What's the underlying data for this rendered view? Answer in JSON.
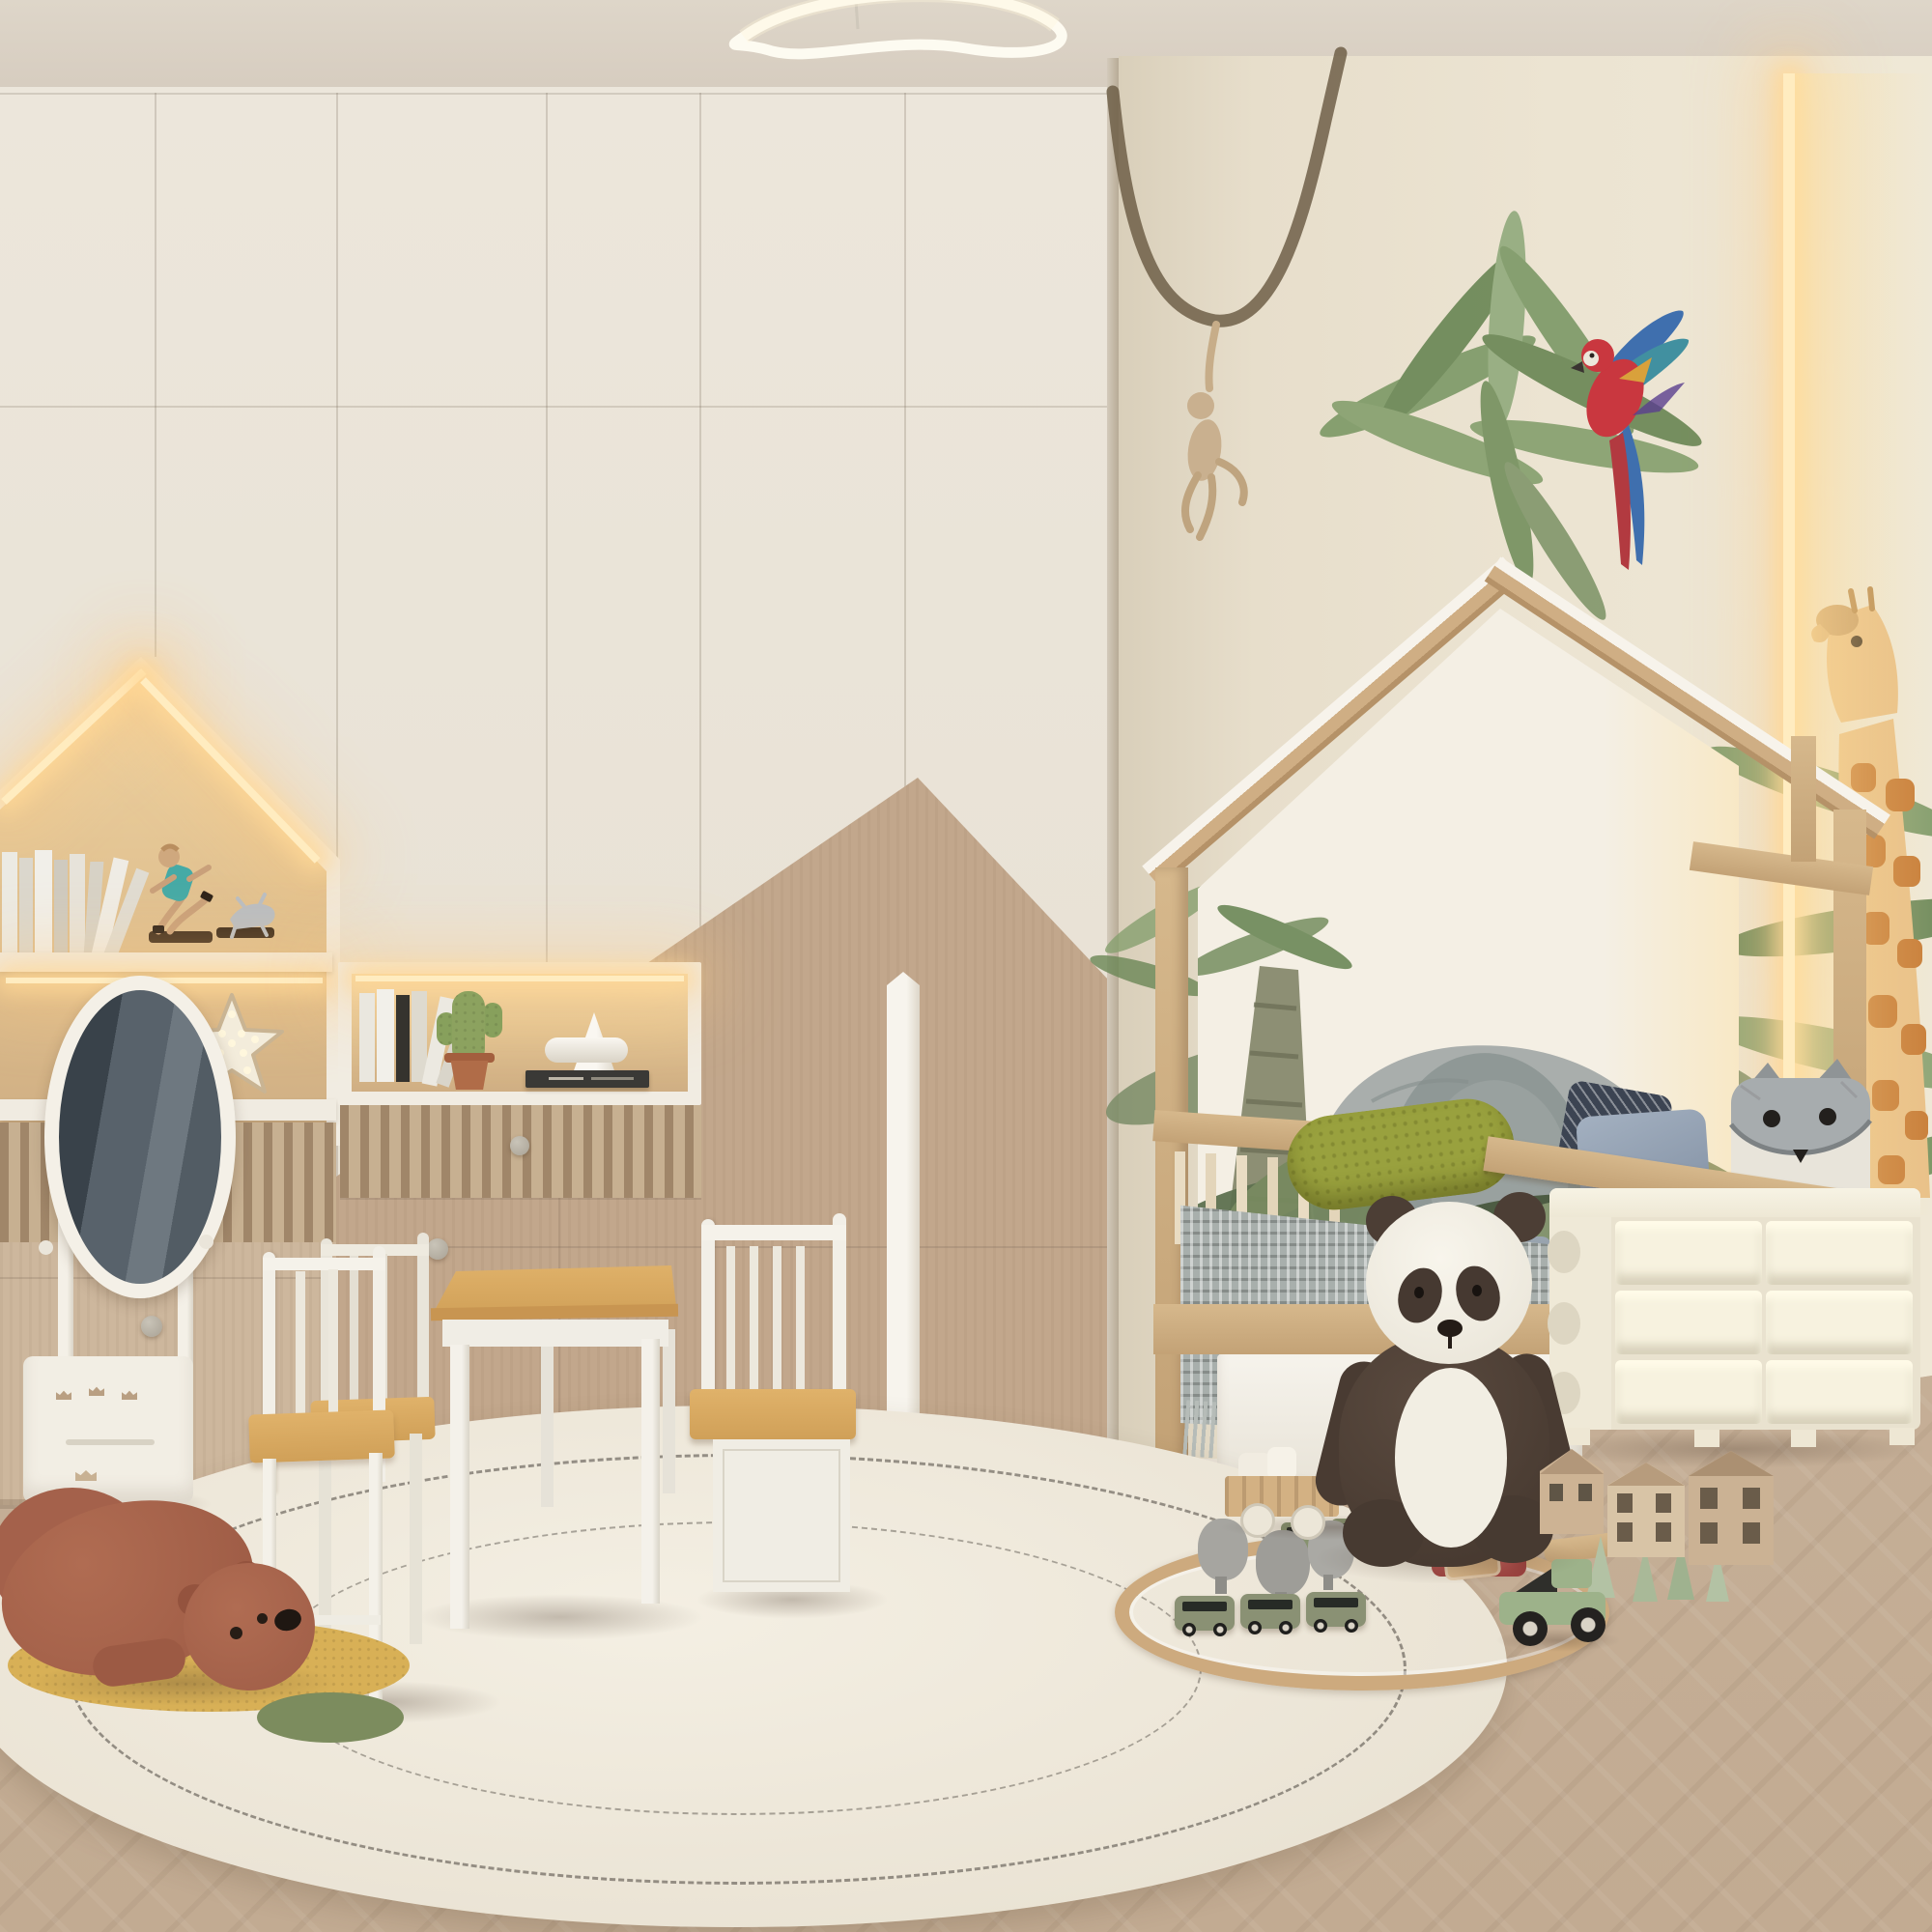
{
  "scene": {
    "description": "3D interior render of a children's bedroom in cream and beige tones with a safari watercolor mural wall, house-frame bed, illuminated wardrobe niches and a round play rug with wooden toys",
    "room_type": "kids bedroom",
    "palette": {
      "ceiling": "#d9d0c4",
      "wardrobe_cream": "#e9e3d7",
      "accent_beige": "#c2a78c",
      "wood_light": "#c9a87c",
      "jungle_wall": "#ebe3d1",
      "floor_wood": "#c9b29a",
      "rug_cream": "#efe9dc",
      "led_warm": "#ffe2a8",
      "panda_dark": "#4c3e35",
      "bear_brown": "#a56049",
      "bolster_olive": "#99a13e",
      "parrot_red": "#c9373f",
      "leaf_green": "#7f9b6b"
    }
  },
  "objects": {
    "ceiling": {
      "label": "Beige ceiling"
    },
    "pendant": {
      "label": "Sculptural curved LED ribbon pendant light"
    },
    "wardrobe": {
      "label": "Cream floor-to-ceiling wardrobe wall with beige mountain accent panel"
    },
    "house_niche": {
      "label": "House-shaped display niche with warm LED strips"
    },
    "shelf_books": {
      "label": "Row of leaning white books"
    },
    "runner_figurine": {
      "label": "Running man figurine with dog on plinths"
    },
    "star_light": {
      "label": "Marquee star night light"
    },
    "display_niche": {
      "label": "Illuminated display niche with books, cactus and ornament"
    },
    "niche_books": {
      "label": "Small stack of standing books"
    },
    "cactus": {
      "label": "Decorative cactus in terracotta pot"
    },
    "ornament": {
      "label": "White geometric cone ornament"
    },
    "flat_book": {
      "label": "Dark book lying flat"
    },
    "dresser": {
      "label": "Fluted slat drawer dresser with round knobs"
    },
    "handle_trim": {
      "label": "Tall white vertical door handle trim"
    },
    "cheval_mirror": {
      "label": "White oval cheval floor mirror with crown-cutout base"
    },
    "jungle_wall": {
      "label": "Safari watercolor mural wall"
    },
    "monkey_vine": {
      "label": "Monkey hanging from a vine wall decal"
    },
    "parrot": {
      "label": "Flying scarlet macaw wall decal"
    },
    "palm": {
      "label": "Watercolor palm tree mural"
    },
    "giraffe": {
      "label": "Giraffe mural at wall edge"
    },
    "led_cove": {
      "label": "Vertical warm LED cove light"
    },
    "house_bed": {
      "label": "Natural wood house-frame kids bed"
    },
    "elephant_mural": {
      "label": "Watercolor elephant headboard mural"
    },
    "bolster": {
      "label": "Olive green textured bolster cushion"
    },
    "pillows": {
      "label": "Blue grey and patterned cushions"
    },
    "fox_pillow": {
      "label": "Grey fox cushion"
    },
    "blanket": {
      "label": "Grey patterned throw with fringe"
    },
    "bed_drawer": {
      "label": "White under-bed storage drawer"
    },
    "panda_plush": {
      "label": "Large sitting plush panda"
    },
    "storage_unit": {
      "label": "Cream plastic toy storage unit with six bins"
    },
    "rug": {
      "label": "Round cream boucle rug with stitched ring lines"
    },
    "train_set": {
      "label": "Wooden oval railway with two green trains"
    },
    "toy_trees_gray": {
      "label": "Grey wooden toy trees"
    },
    "toy_trees_green": {
      "label": "Green cone toy trees"
    },
    "red_bridge": {
      "label": "Red toy tunnel piece"
    },
    "toy_ramp": {
      "label": "Wooden track ramp"
    },
    "toy_car": {
      "label": "Green wooden toy car"
    },
    "toy_houses": {
      "label": "Wooden toy houses"
    },
    "wagons": {
      "label": "Wooden toy wagons with white cargo"
    },
    "bear_plush": {
      "label": "Brown bear floor plush lying on mustard patch"
    },
    "play_table": {
      "label": "Kids play table with natural wood top"
    },
    "chairs": {
      "label": "Two white kids chairs with wood seats"
    },
    "storage_bench": {
      "label": "White kids storage bench with slat back"
    },
    "floor": {
      "label": "Light oak herringbone floor"
    }
  }
}
